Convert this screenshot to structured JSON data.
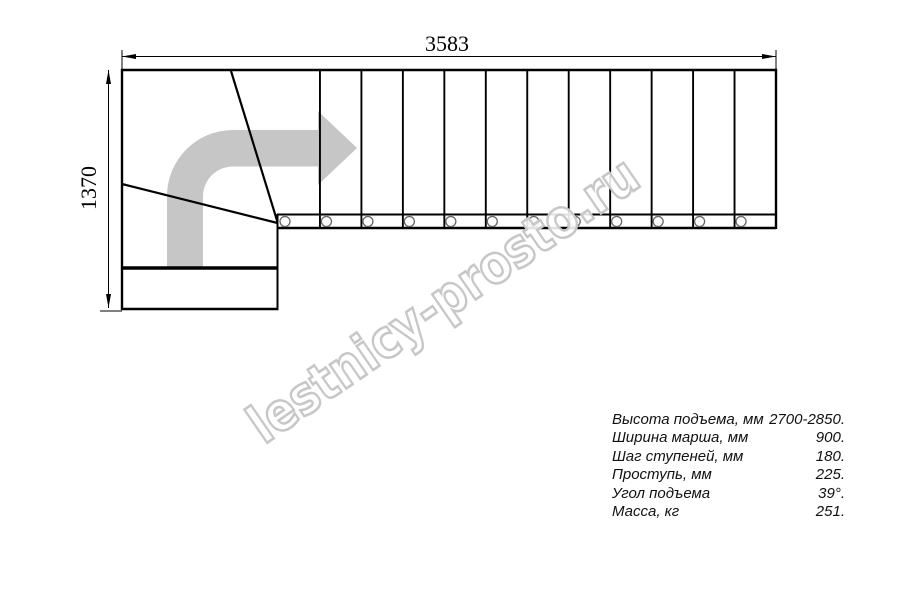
{
  "drawing": {
    "description": "Staircase plan view, L-shaped quarter-turn stair",
    "dimensions": {
      "top_width_mm": "3583",
      "left_height_mm": "1370"
    },
    "stairs": {
      "straight_treads": 12,
      "bolts": 12,
      "winder_corner_treads": 3
    }
  },
  "watermark": {
    "text": "lestnicy-prosto.ru"
  },
  "specs": {
    "rows": [
      {
        "label": "Высота подъема, мм",
        "value": "2700-2850."
      },
      {
        "label": "Ширина марша, мм",
        "value": "900."
      },
      {
        "label": "Шаг ступеней, мм",
        "value": "180."
      },
      {
        "label": "Проступь, мм",
        "value": "225."
      },
      {
        "label": "Угол подъема",
        "value": "39°."
      },
      {
        "label": "Масса, кг",
        "value": "251."
      }
    ]
  },
  "colors": {
    "line": "#000000",
    "dim_line": "#000000",
    "direction_arrow": "#c6c6c6",
    "watermark_stroke": "#c7c7c7",
    "bolt_stroke": "#666666"
  }
}
